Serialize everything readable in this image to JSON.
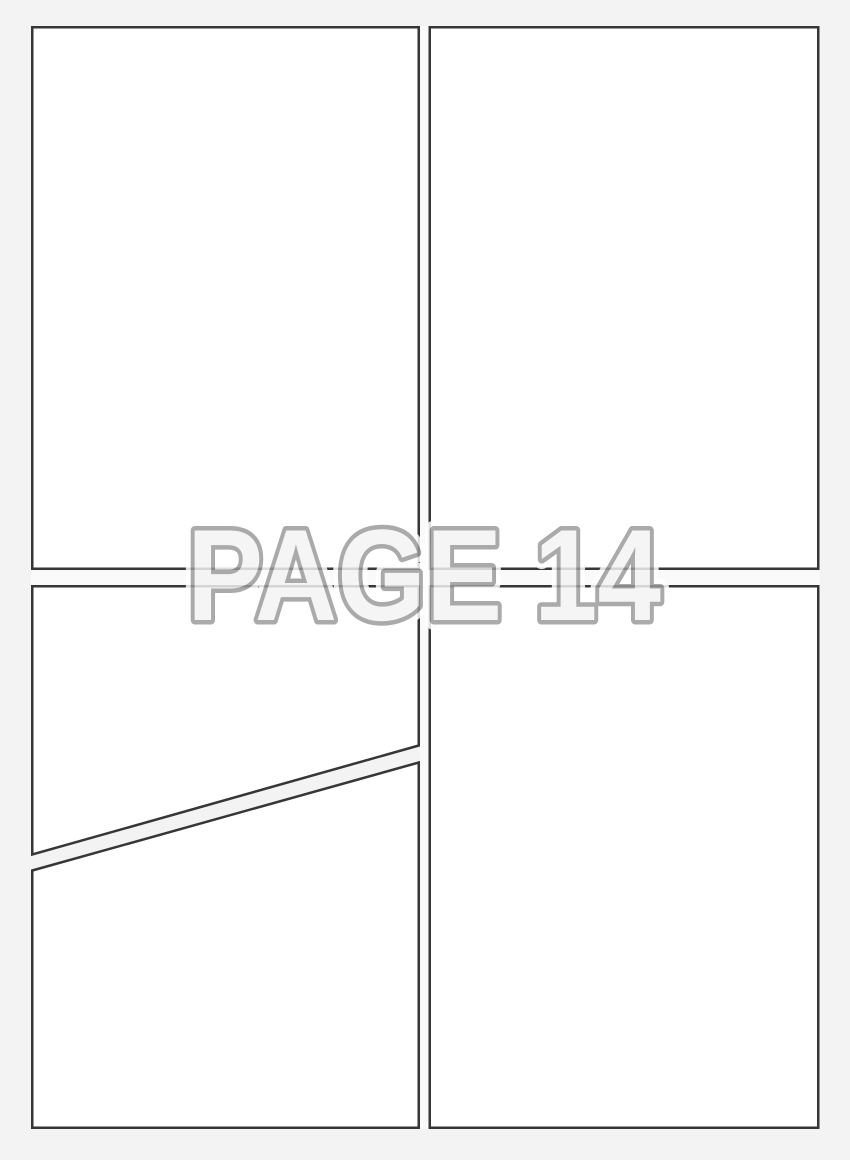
{
  "watermark": {
    "label": "PAGE 14"
  },
  "colors": {
    "background": "#f3f3f3",
    "panel_fill": "#ffffff",
    "panel_border": "#363636",
    "gutter": "#fafafa",
    "watermark_fill": "#f4f4f4",
    "watermark_outline": "#9a9a9a",
    "watermark_halo": "#ffffff"
  },
  "panels": [
    {
      "id": "panel-top-left",
      "content": ""
    },
    {
      "id": "panel-top-right",
      "content": ""
    },
    {
      "id": "panel-middle-left-diagonal",
      "content": ""
    },
    {
      "id": "panel-bottom-left-diagonal",
      "content": ""
    },
    {
      "id": "panel-bottom-right",
      "content": ""
    }
  ]
}
